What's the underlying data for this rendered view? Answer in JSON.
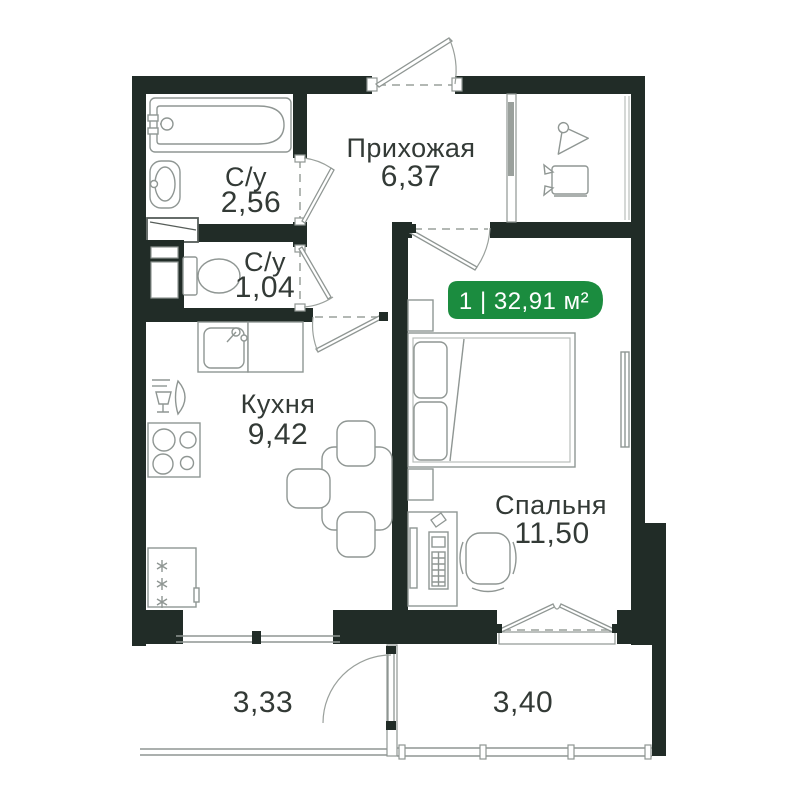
{
  "badge": {
    "label": "1 | 32,91 м²"
  },
  "rooms": {
    "hallway": {
      "name": "Прихожая",
      "area": "6,37"
    },
    "bathroom": {
      "name": "С/у",
      "area": "2,56"
    },
    "wc": {
      "name": "С/у",
      "area": "1,04"
    },
    "kitchen": {
      "name": "Кухня",
      "area": "9,42"
    },
    "bedroom": {
      "name": "Спальня",
      "area": "11,50"
    },
    "loggia_left": {
      "area": "3,33"
    },
    "loggia_right": {
      "area": "3,40"
    }
  },
  "colors": {
    "wall": "#212c27",
    "badge_green": "#1b8c3f",
    "fixture_line": "#8f9693",
    "text": "#333a36",
    "background": "#ffffff"
  },
  "icons": {
    "wardrobe": [
      "hanger-icon",
      "shoe-box-icon"
    ],
    "bathroom": [
      "bathtub-icon",
      "sink-icon",
      "washing-box-icon"
    ],
    "wc": [
      "toilet-icon",
      "vent-shaft"
    ],
    "kitchen": [
      "kitchen-sink-icon",
      "dishes-icon",
      "stove-icon",
      "fridge-icon",
      "dining-table-icon",
      "chair-icon"
    ],
    "bedroom": [
      "bed-icon",
      "nightstand-icon",
      "desk-icon",
      "office-chair-icon",
      "radiator-icon"
    ]
  }
}
